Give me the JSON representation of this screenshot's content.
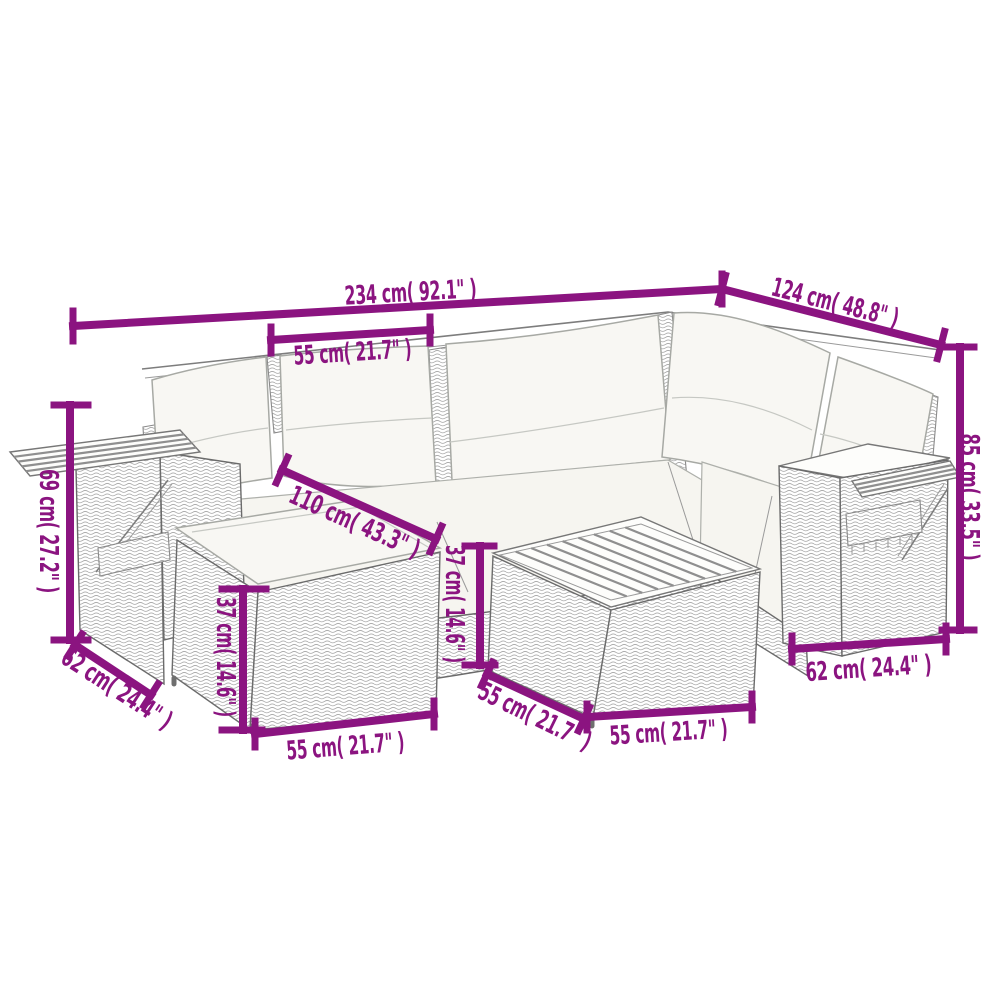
{
  "colors": {
    "dimension_accent": "#8B1480",
    "line_art": "#6b6b6b",
    "background": "#ffffff"
  },
  "diagram": {
    "subject": "garden-lounge-set-with-dimensions",
    "pieces": [
      "corner-sofa",
      "ottoman",
      "coffee-table",
      "fold-out-side-trays"
    ],
    "dimensions": {
      "overall_width": "234 cm( 92.1\" )",
      "seat_width": "55 cm( 21.7\" )",
      "wing_length": "124 cm( 48.8\" )",
      "overall_height": "85 cm( 33.5\" )",
      "arm_height": "69 cm( 27.2\" )",
      "left_arm_depth": "62 cm( 24.4\" )",
      "inner_seat_length": "110 cm( 43.3\" )",
      "ottoman_height": "37 cm( 14.6\" )",
      "ottoman_width": "55 cm( 21.7\" )",
      "table_height": "37 cm( 14.6\" )",
      "table_depth": "55 cm( 21.7\" )",
      "table_width": "55 cm( 21.7\" )",
      "right_arm_depth": "62 cm( 24.4\" )"
    }
  }
}
